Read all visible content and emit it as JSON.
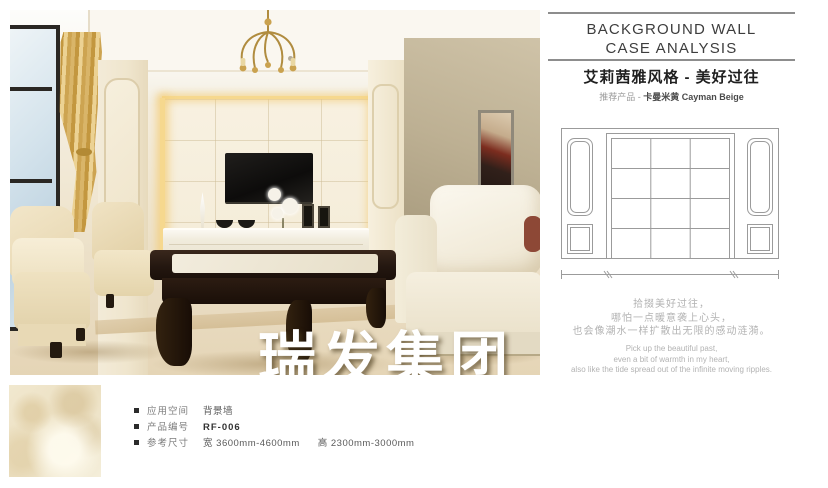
{
  "panel": {
    "title_line1": "BACKGROUND WALL",
    "title_line2": "CASE ANALYSIS",
    "style_title": "艾莉茜雅风格 - 美好过往",
    "product_label": "推荐产品 - ",
    "product_name": "卡曼米黄 Cayman Beige"
  },
  "poem": {
    "cn": [
      "拾掇美好过往，",
      "哪怕一点暖意袭上心头，",
      "也会像潮水一样扩散出无限的感动涟漪。"
    ],
    "en": [
      "Pick up the beautiful past,",
      "even a bit of warmth in my heart,",
      "also like the tide spread out of the infinite moving ripples."
    ]
  },
  "watermark": {
    "text": "瑞发集团"
  },
  "specs": {
    "rows": [
      {
        "label": "应用空间",
        "value": "背景墙"
      },
      {
        "label": "产品编号",
        "value": "RF-006"
      },
      {
        "label": "参考尺寸",
        "value": "宽 3600mm-4600mm",
        "value2": "高 2300mm-3000mm"
      }
    ]
  },
  "colors": {
    "divider_gray": "#8d8d8d",
    "poem_gray": "#b3b3b3",
    "accent_gold": "#c8a24e",
    "marble_cream": "#f2ead8",
    "tv_black": "#141210"
  }
}
